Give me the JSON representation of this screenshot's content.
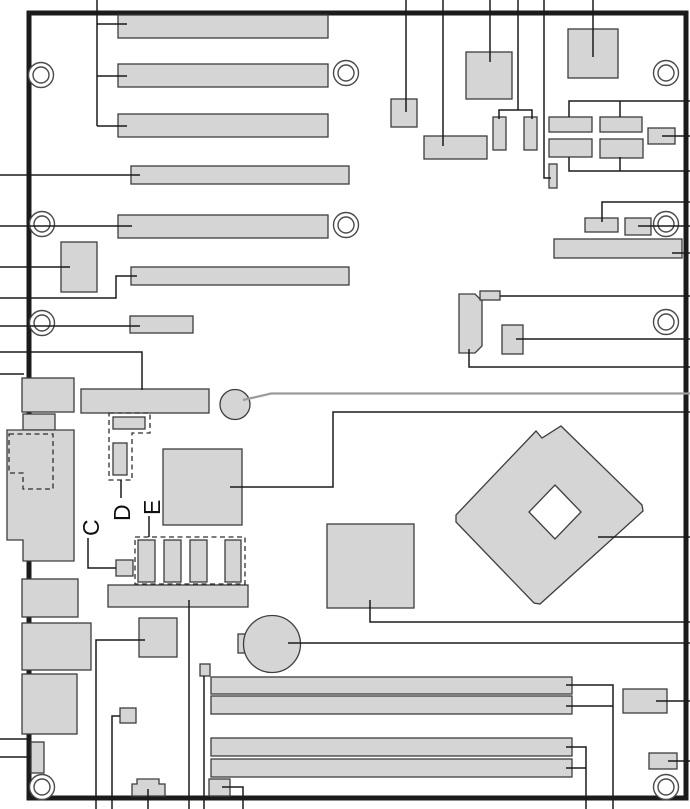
{
  "diagram": {
    "type": "motherboard-component-layout",
    "labels": {
      "c": "C",
      "d": "D",
      "e": "E"
    },
    "components": [
      "expansion-slot",
      "io-back-panel-connector",
      "cpu-socket",
      "dimm-slot",
      "coin-cell-battery",
      "mounting-hole",
      "jumper-block",
      "ic-chip",
      "pin-header",
      "front-panel-audio-header"
    ],
    "colors": {
      "background": "#ffffff",
      "component_fill": "#d5d5d5",
      "component_stroke": "#3d3d3d",
      "board_outline": "#1b1b1b",
      "callout_line": "#1b1b1b",
      "callout_line_gray": "#9b9b9b",
      "dashed_outline": "#2e2e2e",
      "hole_stroke": "#4a4a4a",
      "label_color": "#101010"
    }
  }
}
